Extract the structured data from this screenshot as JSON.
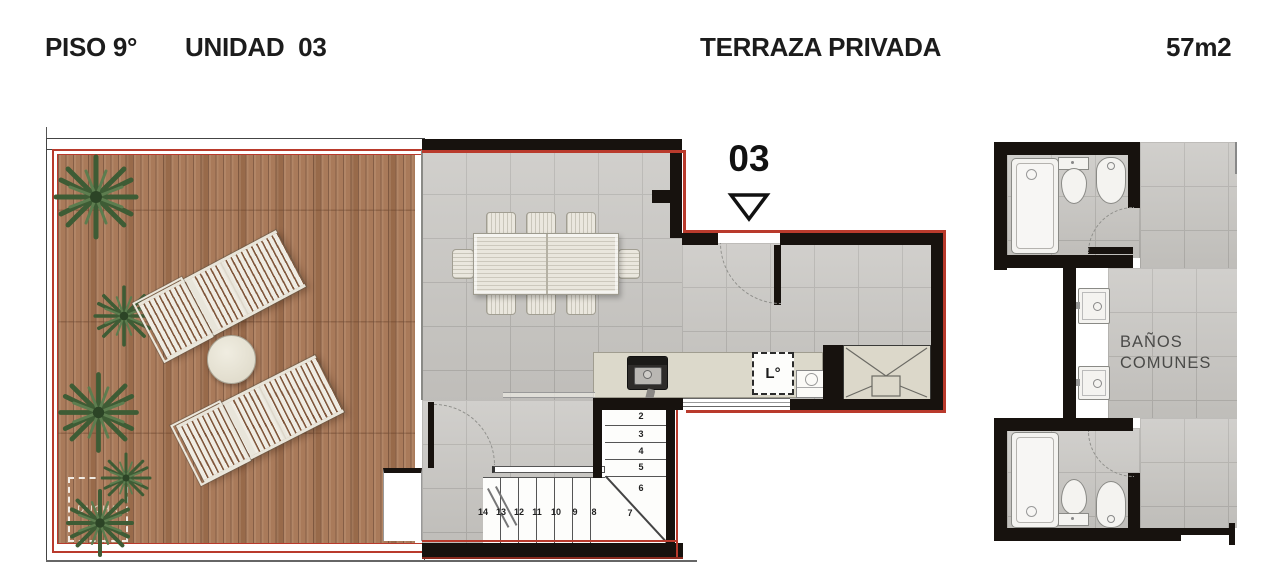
{
  "header": {
    "floor_label": "PISO 9°",
    "unit_label": "UNIDAD  03",
    "plan_title": "TERRAZA PRIVADA",
    "area_label": "57m2"
  },
  "unit_marker": {
    "number": "03"
  },
  "terrace": {
    "shower_label": "DUCHA"
  },
  "kitchen": {
    "laundry_label": "L°"
  },
  "common_baths": {
    "line1": "BAÑOS",
    "line2": "COMUNES"
  },
  "stairs": {
    "steps": [
      "2",
      "3",
      "4",
      "5",
      "6",
      "7",
      "8",
      "9",
      "10",
      "11",
      "12",
      "13",
      "14"
    ]
  },
  "colors": {
    "outline_red": "#b93a2c",
    "wall_black": "#17120e",
    "deck_wood": "#a97a5a",
    "floor_tile": "#c7c5c1",
    "furniture_cream": "#efece3",
    "plant_green": "#3e5c35"
  }
}
